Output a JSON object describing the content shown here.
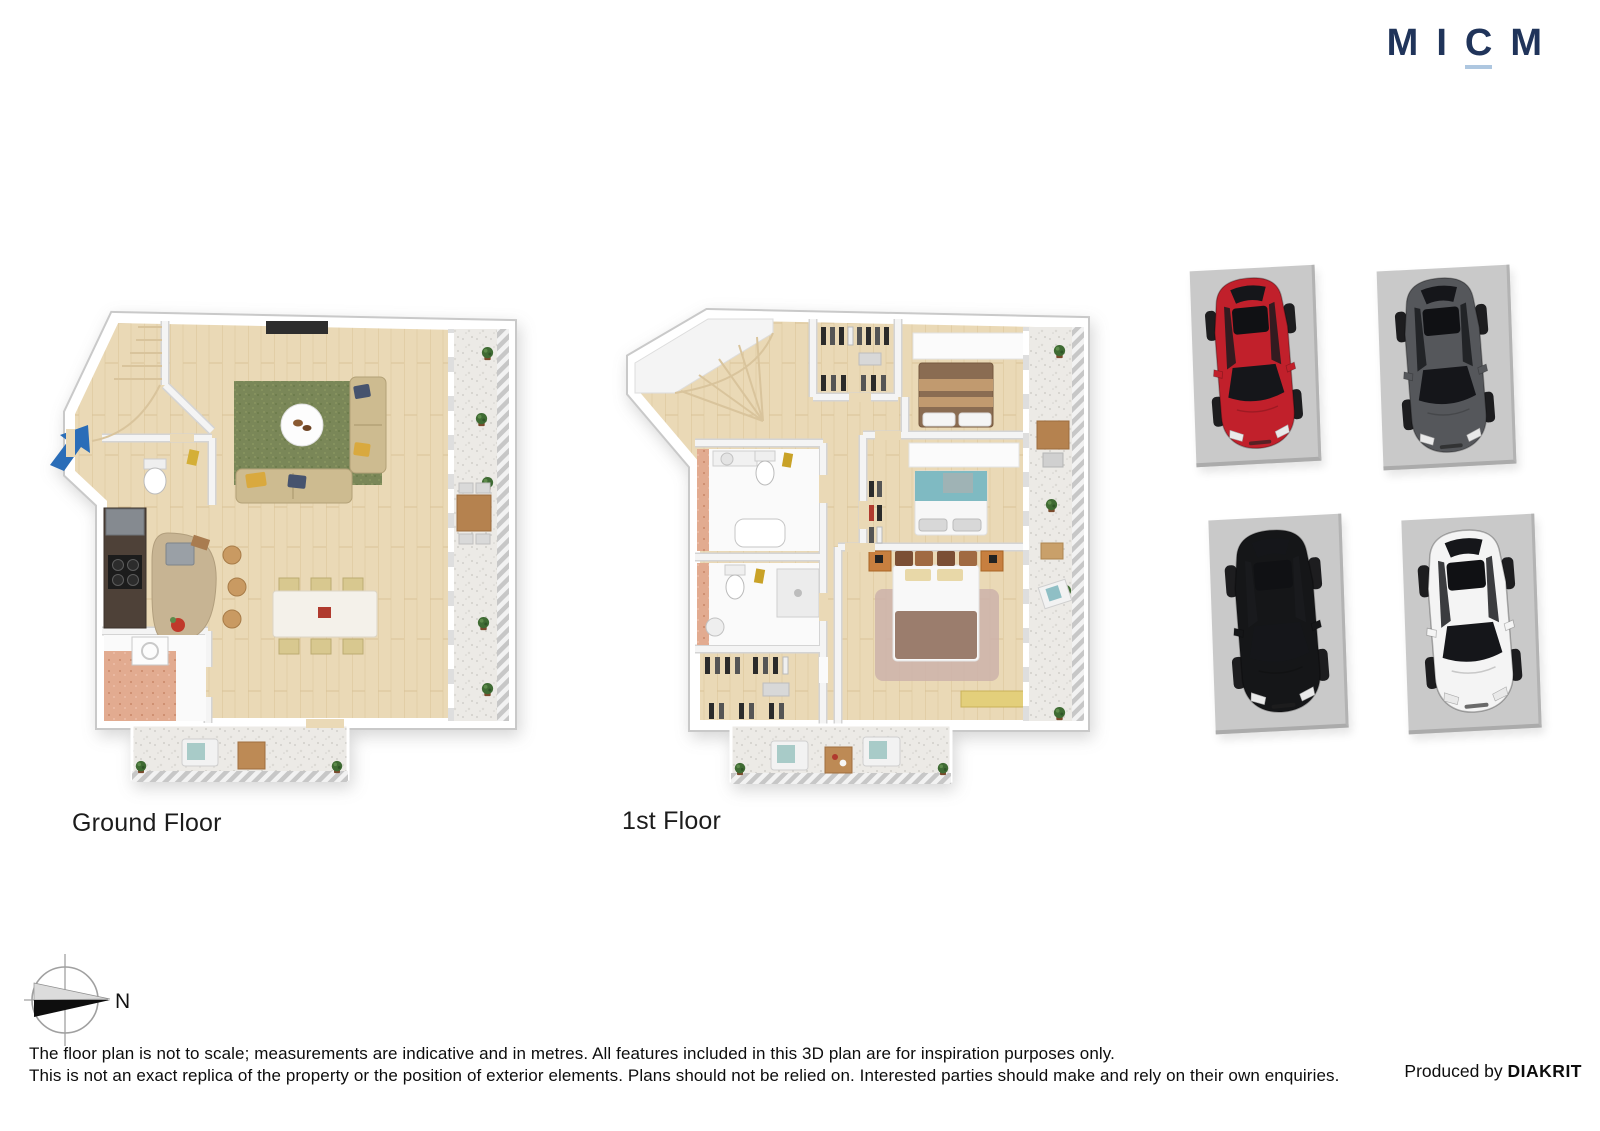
{
  "brand": {
    "letters": [
      "M",
      "I",
      "C",
      "M"
    ],
    "color": "#20345a",
    "underline_color": "#aec7e0"
  },
  "floors": [
    {
      "id": "ground-floor",
      "label": "Ground Floor"
    },
    {
      "id": "first-floor",
      "label": "1st Floor"
    }
  ],
  "parking": {
    "spaces": [
      {
        "name": "red-car",
        "color": "#c1202b"
      },
      {
        "name": "grey-car",
        "color": "#55575b"
      },
      {
        "name": "black-car",
        "color": "#151618"
      },
      {
        "name": "white-car",
        "color": "#f4f4f4"
      }
    ]
  },
  "compass": {
    "north_label": "N"
  },
  "palette": {
    "wood_floor": "#ead9b6",
    "balcony_stone": "#eceae6",
    "rug_green": "#7a8758",
    "bathroom_pink": "#e2ab90",
    "entry_arrow_blue": "#2a6db8",
    "wall_white": "#ffffff"
  },
  "footer": {
    "disclaimer_line1": "The floor plan is not to scale; measurements are indicative and in metres. All features included in this 3D plan are for inspiration purposes only.",
    "disclaimer_line2": "This is not an exact replica of the property or the position of exterior elements. Plans should not be relied on. Interested parties should make and rely on their own enquiries.",
    "produced_by_label": "Produced by",
    "producer": "DIAKRIT"
  }
}
